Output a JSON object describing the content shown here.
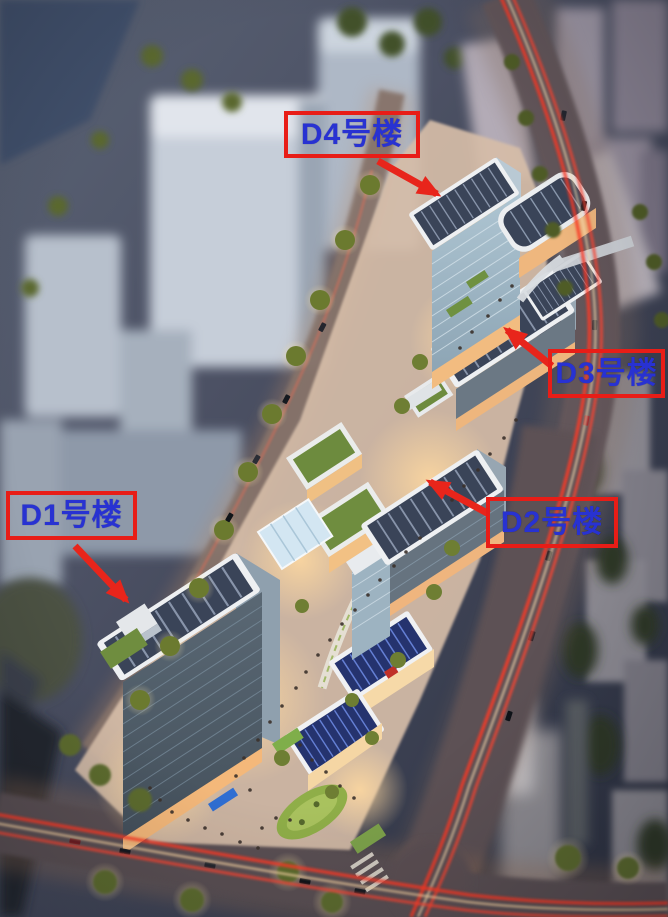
{
  "annotations": {
    "labels": [
      {
        "id": "d1",
        "text": "D1号楼"
      },
      {
        "id": "d2",
        "text": "D2号楼"
      },
      {
        "id": "d3",
        "text": "D3号楼"
      },
      {
        "id": "d4",
        "text": "D4号楼"
      }
    ],
    "colors": {
      "label_text": "#2832d2",
      "label_border": "#e81d17",
      "arrow": "#e8251b"
    }
  }
}
